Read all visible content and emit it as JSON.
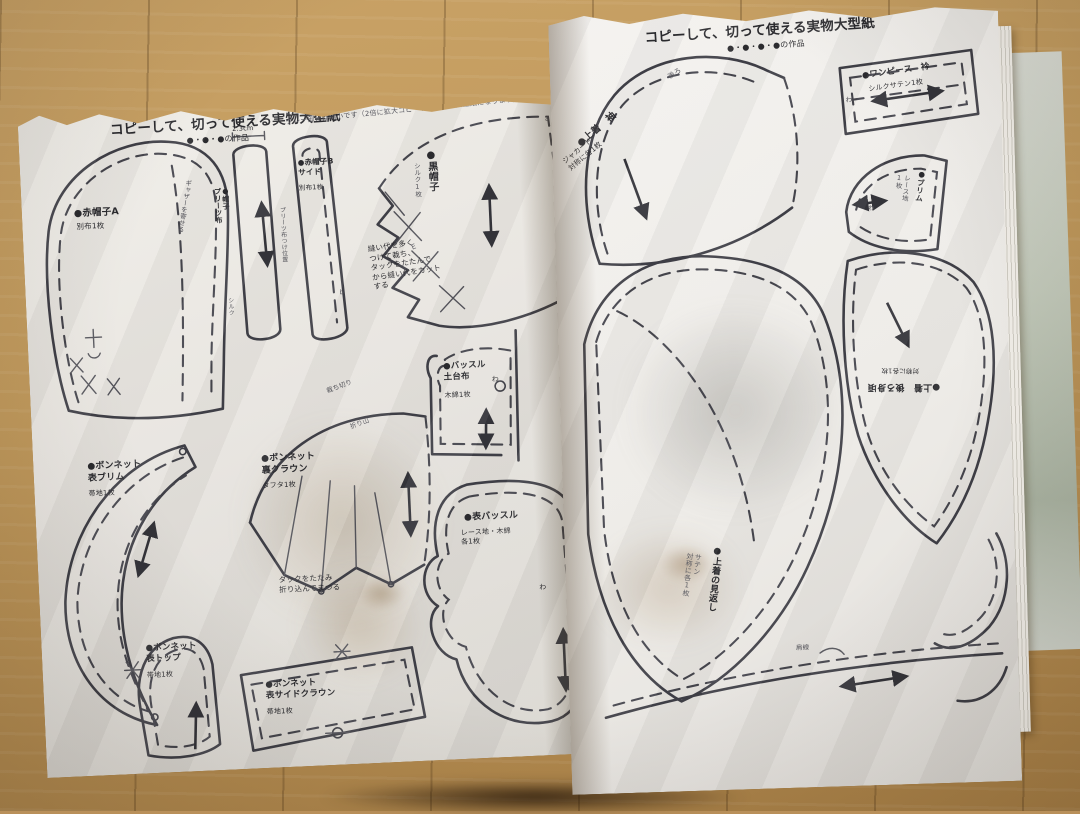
{
  "left": {
    "header": "コピーして、切って使える実物大型紙",
    "works": "●・●・●の作品",
    "note": "グレー部分は縮小です（2倍に拡大コピーすると実物大型紙になります）",
    "pieces": {
      "red_hat_a": {
        "name": "●赤帽子A",
        "fabric": "別布1枚",
        "gather": "ギャザーを寄せる"
      },
      "pleats_strip": {
        "name": "●帽子\nプリーツ布",
        "fabric": "シルク",
        "dim": "2.3cm"
      },
      "red_hat_b": {
        "name": "●赤帽子B\nサイド",
        "fabric": "別布1枚",
        "note": "プリーツ布つけ位置"
      },
      "black_hat": {
        "name": "●黒帽子",
        "fabric": "シルク1枚",
        "note": "縫い代を多く\nつけて裁ち、\nタックをたたんで\nから縫い代をカット\nする"
      },
      "bustle_base": {
        "name": "●バッスル\n土台布",
        "fabric": "木綿1枚",
        "fold": "わ"
      },
      "bonnet_front_brim": {
        "name": "●ボンネット\n表ブリム",
        "fabric": "帯地1枚"
      },
      "bonnet_back_crown": {
        "name": "●ボンネット\n裏クラウン",
        "fabric": "タフタ1枚",
        "cut_edge": "裁ち切り",
        "fold_line": "折り山",
        "tuck_note": "タックをたたみ\n折り込んでまつる"
      },
      "front_bustle": {
        "name": "●表バッスル",
        "fabric": "レース地・木綿\n各1枚",
        "fold": "わ"
      },
      "bonnet_top": {
        "name": "●ボンネット\n表トップ",
        "fabric": "帯地1枚"
      },
      "bonnet_side_crown": {
        "name": "●ボンネット\n表サイドクラウン",
        "fabric": "帯地1枚"
      }
    },
    "marks": {
      "a": "a",
      "b": "b",
      "d": "d",
      "e": "E"
    }
  },
  "right": {
    "header": "コピーして、切って使える実物大型紙",
    "works": "●・●・●・●の作品",
    "pieces": {
      "jacket_sleeve": {
        "name": "●上着　袖",
        "fabric": "ジャカード\n対称に各1枚",
        "mark": "後ろ"
      },
      "dress_collar": {
        "name": "●ワンピース　衿",
        "fabric": "シルクサテン1枚",
        "fold": "わ"
      },
      "lace_brim": {
        "name": "●ブリム",
        "fabric": "レース地\n1枚",
        "fold": "わ"
      },
      "jacket_back": {
        "name": "●上着　後ろ身頃",
        "fabric": "対称に各1枚"
      },
      "jacket_facing": {
        "name": "●上着の見返し",
        "fabric": "サテン\n対称に各1枚"
      },
      "shoulder_line": "肩線"
    }
  }
}
